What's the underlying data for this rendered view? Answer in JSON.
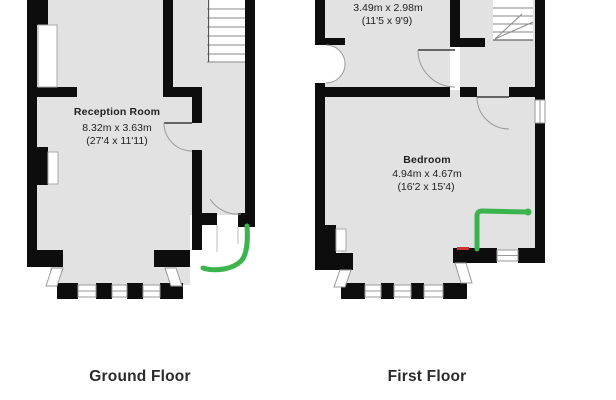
{
  "ground_floor": {
    "title": "Ground Floor",
    "reception_room": {
      "name": "Reception Room",
      "size_metric": "8.32m x 3.63m",
      "size_imperial": "(27'4 x 11'11)"
    }
  },
  "first_floor": {
    "title": "First Floor",
    "top_room": {
      "size_metric": "3.49m x 2.98m",
      "size_imperial": "(11'5 x 9'9)"
    },
    "bedroom": {
      "name": "Bedroom",
      "size_metric": "4.94m x 4.67m",
      "size_imperial": "(16'2 x 15'4)"
    }
  },
  "colors": {
    "wall": "#0d0d0d",
    "floor": "#e2e2e2",
    "annotation_green": "#3cb44e",
    "annotation_red": "#cc3333"
  }
}
